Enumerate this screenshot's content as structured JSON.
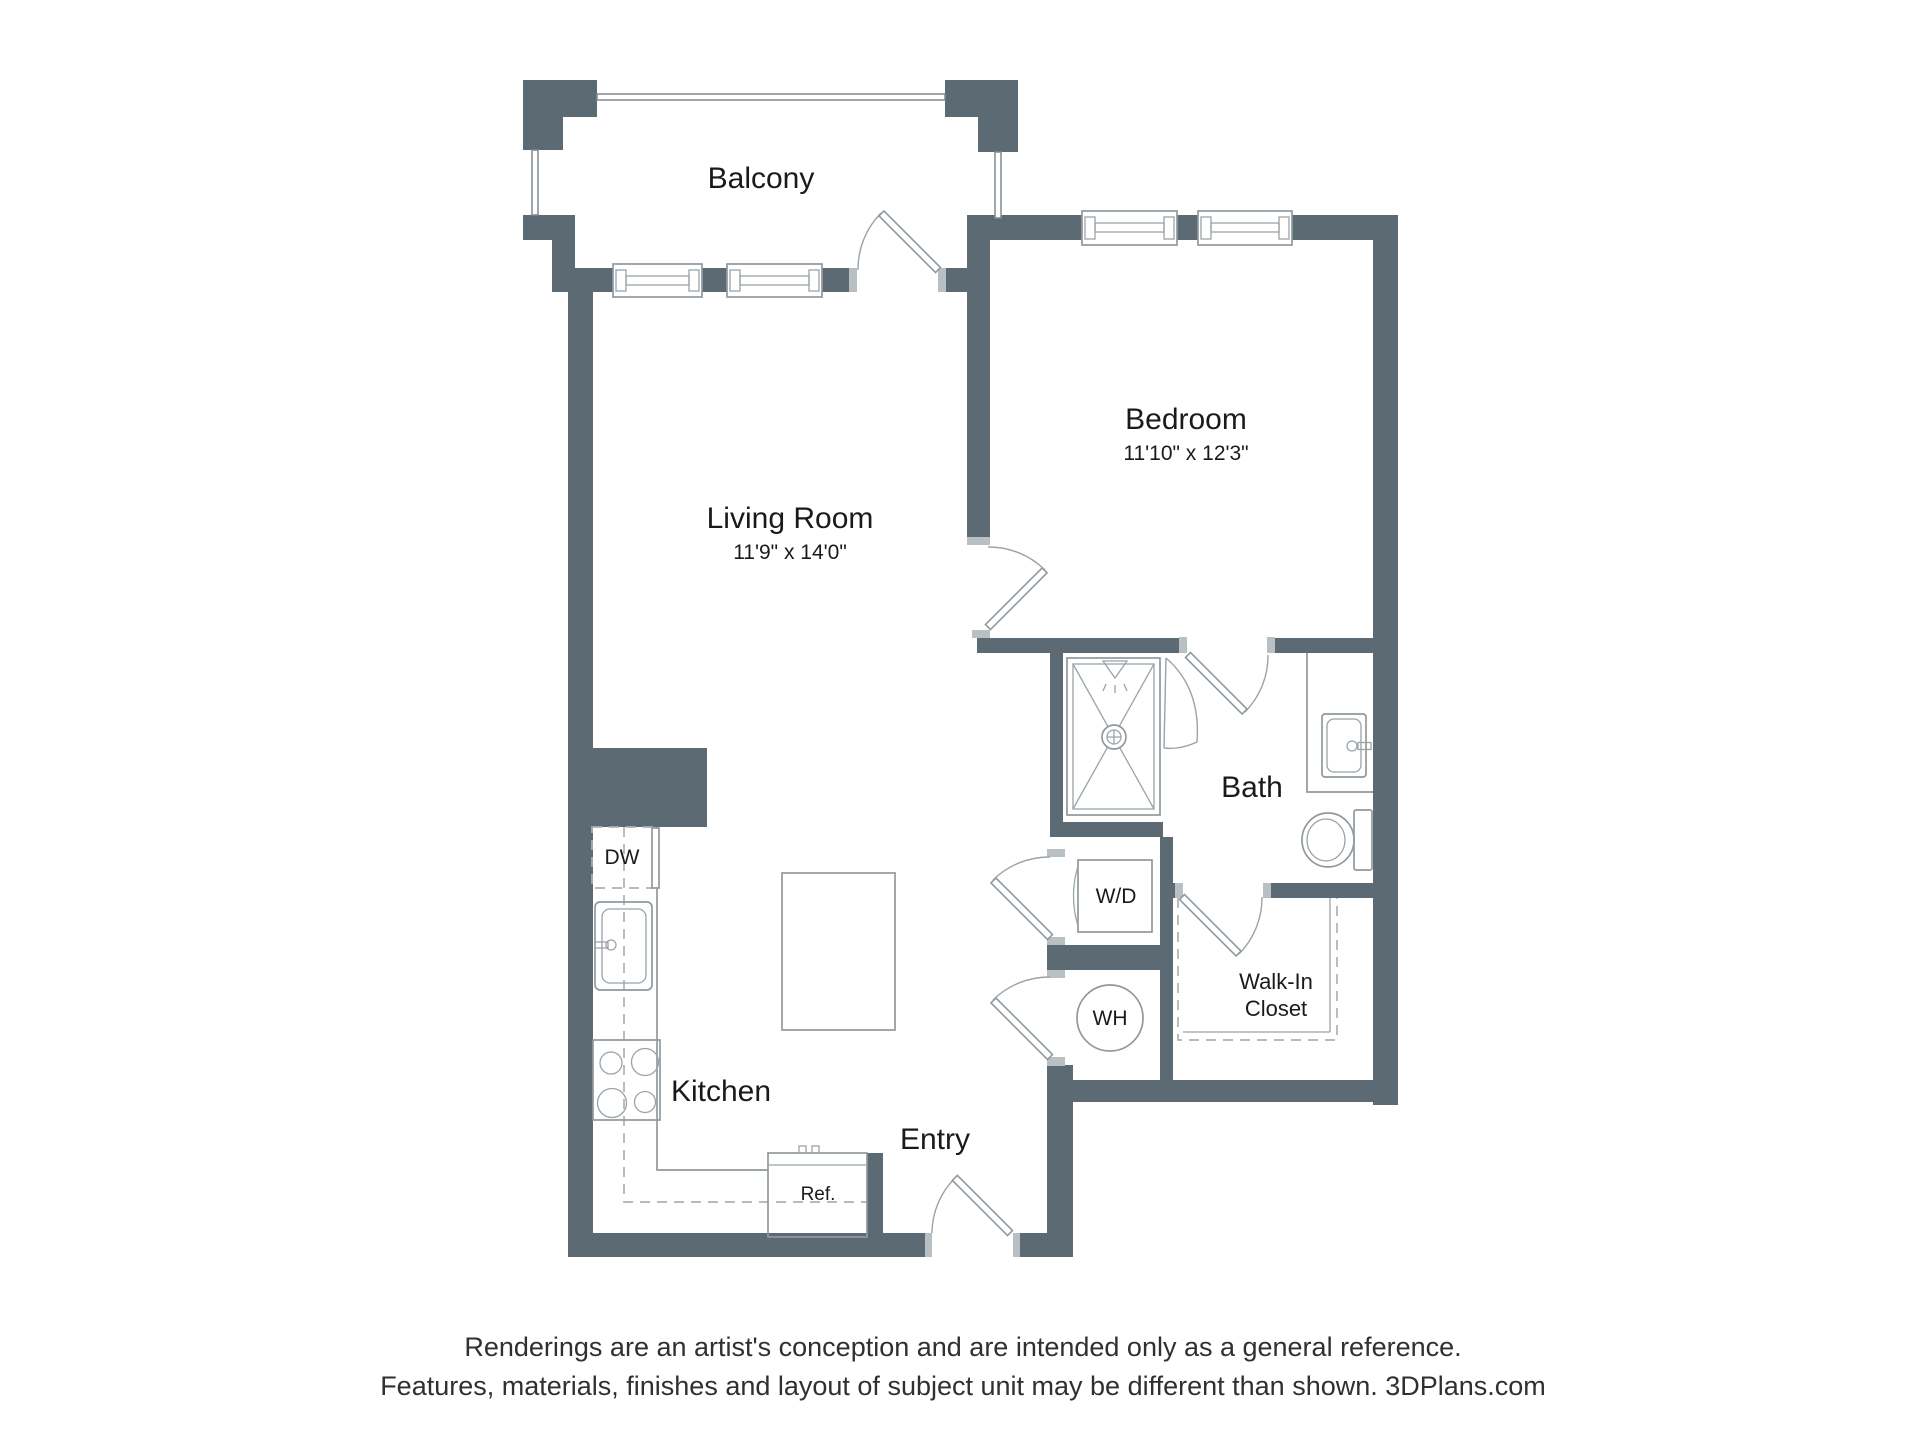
{
  "colors": {
    "wall": "#5c6b73",
    "jamb": "#b9c0c4",
    "fixture_line": "#8f999e",
    "dashed_line": "#abb2b6",
    "label_text": "#1a1a1a",
    "disclaimer_text": "#303030",
    "background": "#ffffff"
  },
  "rooms": {
    "balcony": {
      "label": "Balcony"
    },
    "living_room": {
      "label": "Living Room",
      "dimensions": "11'9\" x 14'0\""
    },
    "bedroom": {
      "label": "Bedroom",
      "dimensions": "11'10\" x 12'3\""
    },
    "bath": {
      "label": "Bath"
    },
    "kitchen": {
      "label": "Kitchen"
    },
    "entry": {
      "label": "Entry"
    },
    "walk_in_closet": {
      "label_line1": "Walk-In",
      "label_line2": "Closet"
    }
  },
  "fixtures": {
    "dishwasher": "DW",
    "washer_dryer": "W/D",
    "water_heater": "WH",
    "refrigerator": "Ref."
  },
  "disclaimer": {
    "line1": "Renderings are an artist's conception and are intended only as a general reference.",
    "line2": "Features, materials, finishes and layout of subject unit may be different than shown. 3DPlans.com"
  }
}
